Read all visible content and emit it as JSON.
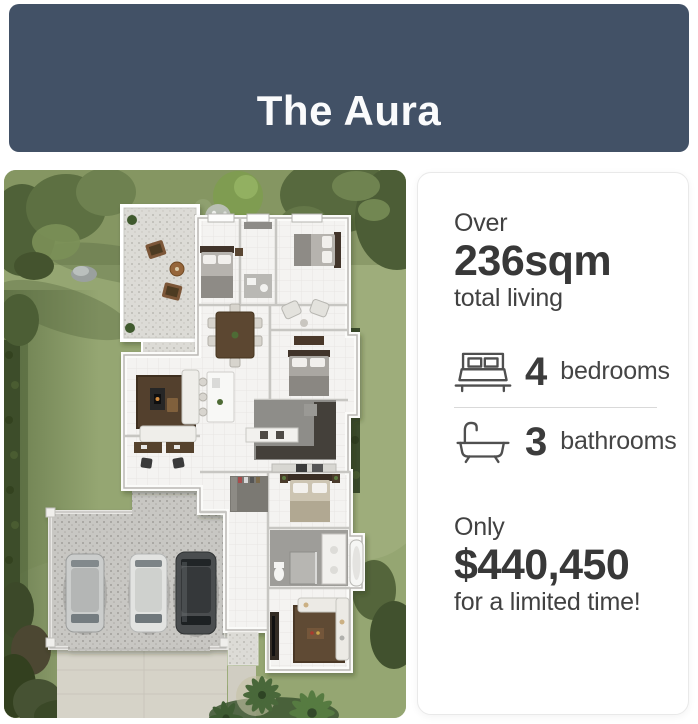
{
  "header": {
    "title": "The Aura",
    "background_color": "#425166",
    "text_color": "#fafbfc"
  },
  "floorplan": {
    "description": "3D aerial render of The Aura single-storey home floor plan: lawn and dark hedges surround the house, alfresco gravel terrace with outdoor chairs top left, four bedrooms, open plan dining kitchen and living areas, study with two desks, master suite with walk-in robe and bathroom, media room, triple garage with three parked cars and concrete driveway, palm trees at bottom right"
  },
  "details_card": {
    "size": {
      "prefix": "Over",
      "value": "236sqm",
      "suffix": "total living"
    },
    "features": [
      {
        "icon": "bed-icon",
        "count": "4",
        "label": "bedrooms"
      },
      {
        "icon": "bath-icon",
        "count": "3",
        "label": "bathrooms"
      }
    ],
    "price": {
      "prefix": "Only",
      "value": "$440,450",
      "suffix": "for a limited time!"
    },
    "text_color": "#3f3f3f",
    "divider_color": "#d9d9d9",
    "icon_color": "#4f4f4f"
  }
}
